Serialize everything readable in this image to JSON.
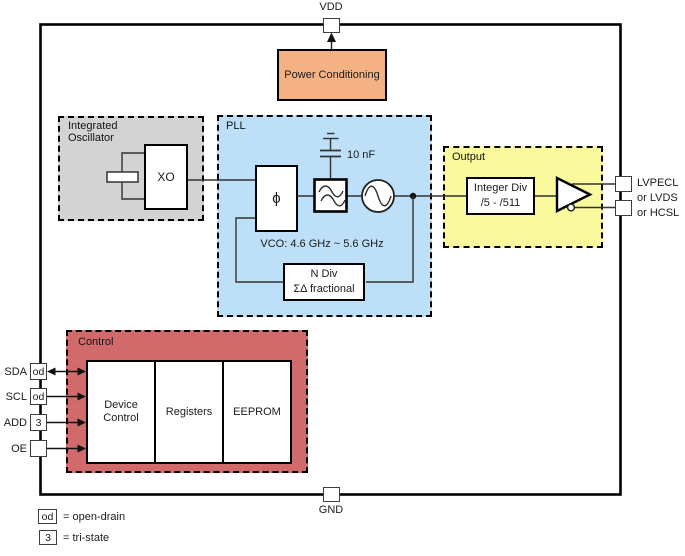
{
  "pins": {
    "vdd": {
      "label": "VDD"
    },
    "gnd": {
      "label": "GND"
    },
    "left": [
      {
        "name": "SDA",
        "badge": "od"
      },
      {
        "name": "SCL",
        "badge": "od"
      },
      {
        "name": "ADD",
        "badge": "3"
      },
      {
        "name": "OE",
        "badge": ""
      }
    ],
    "output_labels": {
      "line1": "LVPECL",
      "line2": "or LVDS",
      "line3": "or HCSL"
    }
  },
  "blocks": {
    "power_conditioning": {
      "label": "Power Conditioning"
    },
    "integrated_oscillator": {
      "label": "Integrated Oscillator"
    },
    "xo": {
      "label": "XO"
    },
    "pll": {
      "label": "PLL",
      "phase_detector_symbol": "ϕ",
      "capacitor_value": "10 nF",
      "vco_range": "VCO: 4.6 GHz ~ 5.6 GHz",
      "n_div": {
        "line1": "N Div",
        "line2": "ΣΔ fractional"
      }
    },
    "output": {
      "label": "Output",
      "integer_div": {
        "line1": "Integer Div",
        "line2": "/5 - /511"
      }
    },
    "control": {
      "label": "Control",
      "sections": [
        "Device Control",
        "Registers",
        "EEPROM"
      ]
    }
  },
  "legend": [
    {
      "badge": "od",
      "text": "= open-drain"
    },
    {
      "badge": "3",
      "text": "= tri-state"
    }
  ],
  "colors": {
    "power_conditioning": "#F4B183",
    "integrated_oscillator": "#D3D3D3",
    "pll": "#BDDFF7",
    "output": "#FAF99D",
    "control": "#D06A6B"
  },
  "icons": {
    "crystal": "crystal-resonator-icon",
    "loop_filter": "wave-filter-icon",
    "vco": "sine-oscillator-icon",
    "output_buffer": "buffer-triangle-icon",
    "capacitor": "capacitor-to-ground-icon",
    "vdd_arrow": "up-arrow-icon",
    "junction": "junction-dot"
  }
}
